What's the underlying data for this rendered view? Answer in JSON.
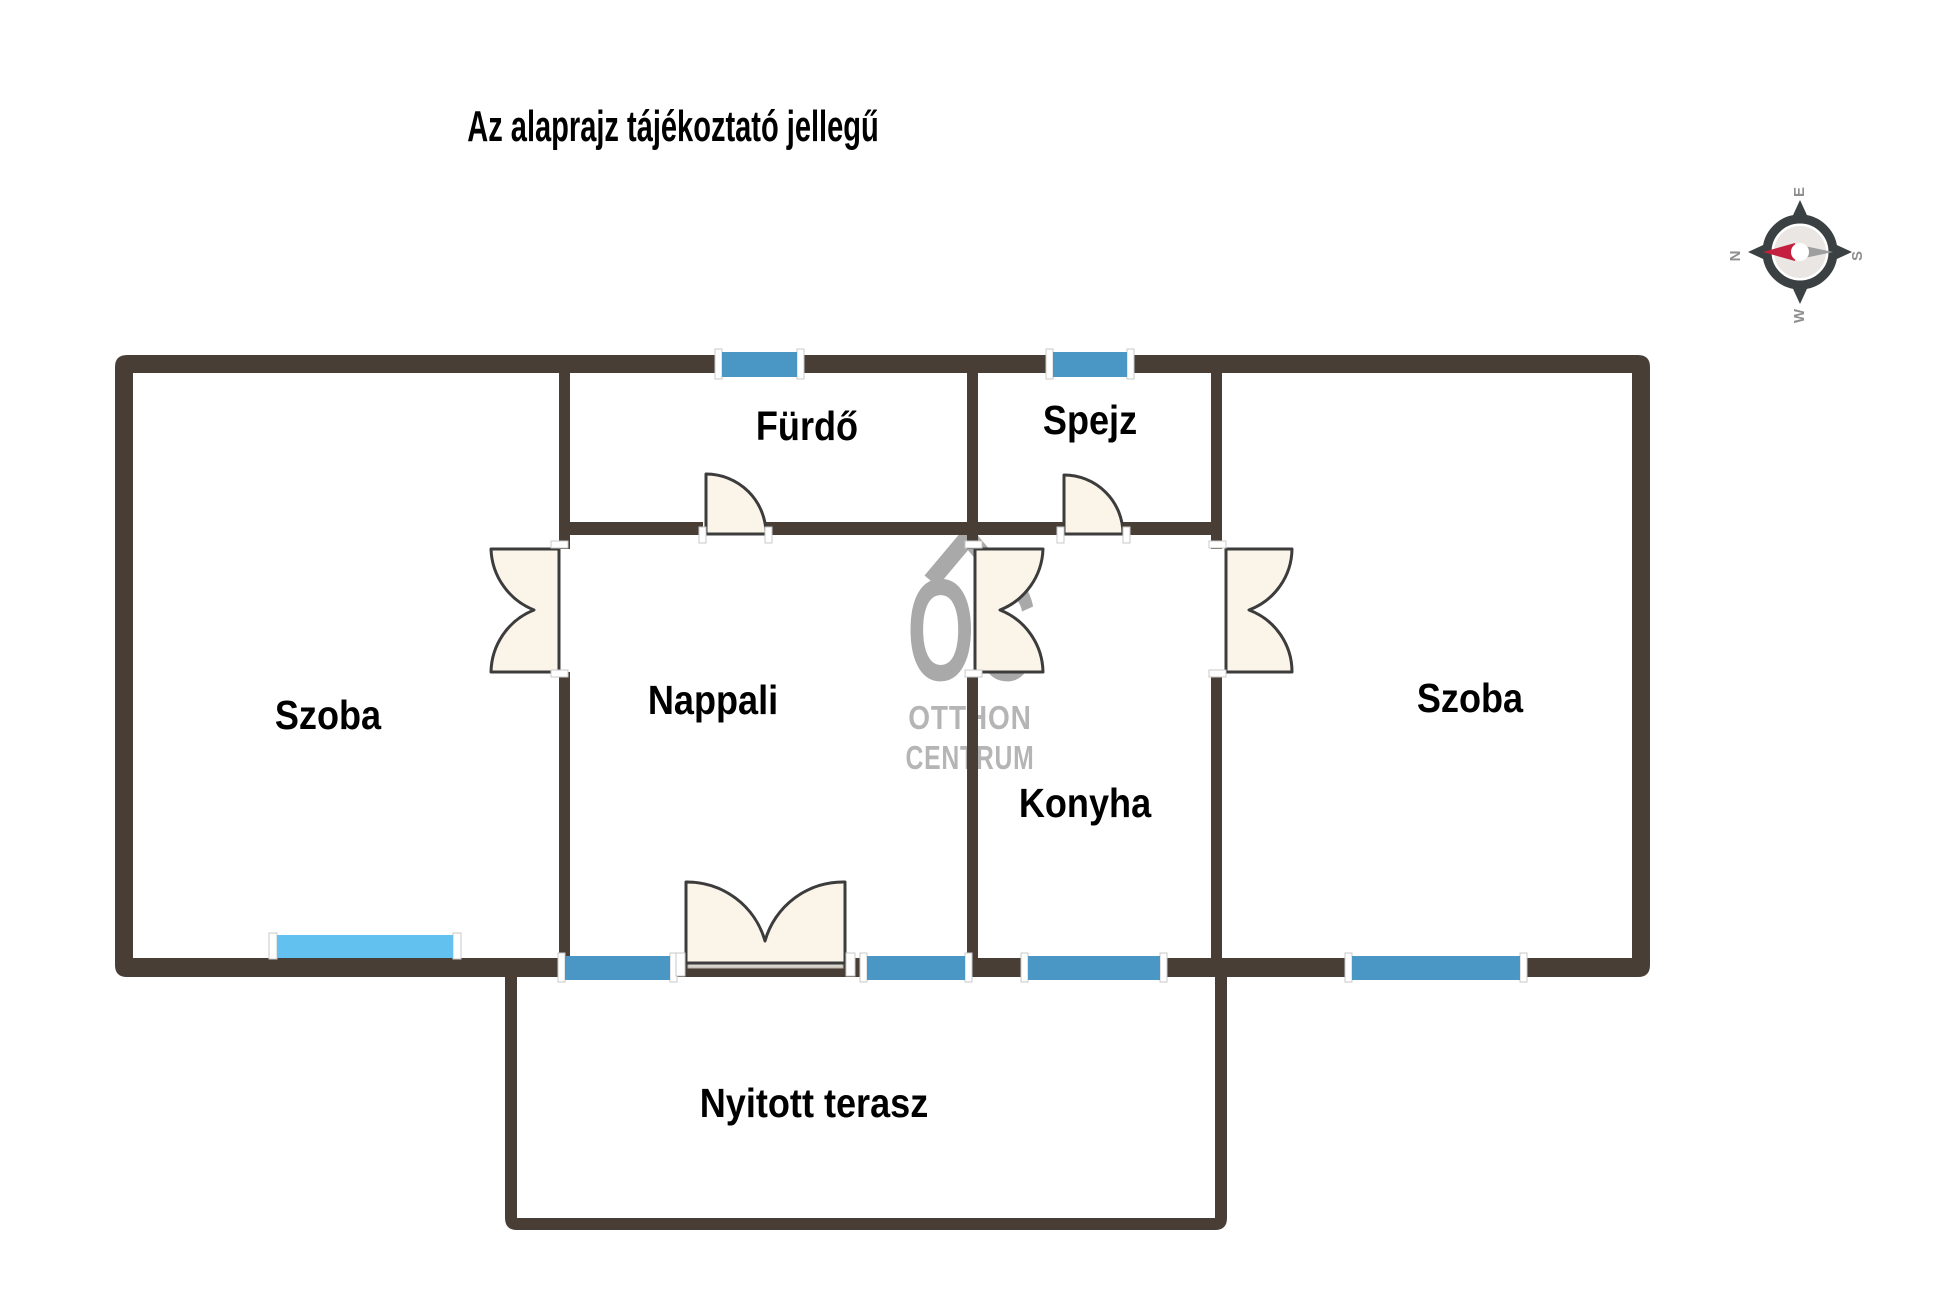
{
  "title": "Az alaprajz tájékoztató jellegű",
  "rooms": {
    "szoba_left": "Szoba",
    "furdo": "Fürdő",
    "spejz": "Spejz",
    "nappali": "Nappali",
    "konyha": "Konyha",
    "szoba_right": "Szoba",
    "terasz": "Nyitott terasz"
  },
  "watermark": {
    "logo": "OC",
    "line1": "OTTHON",
    "line2": "CENTRUM"
  },
  "compass": {
    "n": "N",
    "e": "E",
    "s": "S",
    "w": "W"
  },
  "colors": {
    "wall": "#493E35",
    "window_blue": "#4A96C4",
    "window_light": "#63C1EF",
    "door_fill": "#FBF4E9",
    "door_stroke": "#3C3C3C",
    "threshold": "#D8D3CC",
    "cap": "#FFFFFF",
    "watermark_gray": "#A9A9A9",
    "watermark_light_gray": "#B5B5B5",
    "compass_dark": "#3B4143",
    "compass_letter": "#8F8F8F",
    "needle_red": "#C41F3E",
    "needle_gray": "#9E9E9E",
    "compass_disc": "#E9E6E3",
    "label": "#000000"
  }
}
